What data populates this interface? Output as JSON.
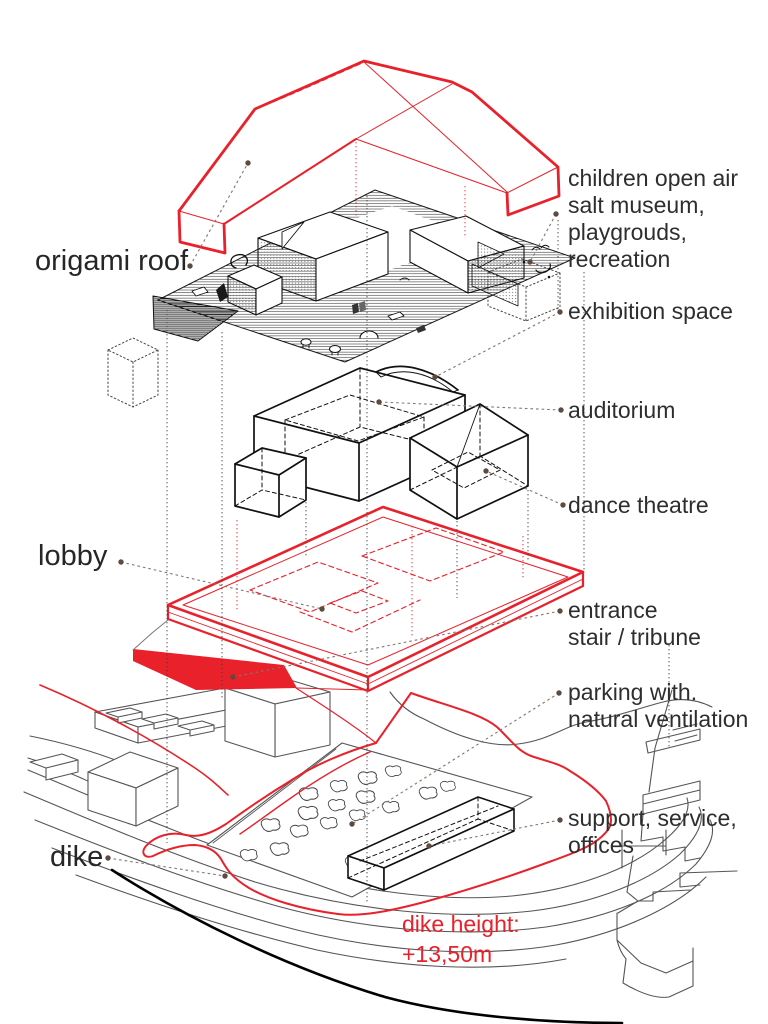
{
  "diagram": {
    "kind": "exploded axonometric architectural diagram",
    "colors": {
      "accent_red": "#e8212b",
      "ink": "#1a1a1a",
      "grey_line": "#555555",
      "leader": "#87756a",
      "leader_dot": "#5d4b40",
      "background": "#ffffff"
    },
    "labels": {
      "origami_roof": "origami roof",
      "lobby": "lobby",
      "dike": "dike",
      "children": [
        "children open air",
        "salt museum,",
        "playgrouds,",
        "recreation"
      ],
      "exhibition": "exhibition space",
      "auditorium": "auditorium",
      "dance_theatre": "dance theatre",
      "entrance": [
        "entrance",
        "stair / tribune"
      ],
      "parking": [
        "parking with.",
        "natural ventilation"
      ],
      "support": [
        "support, service,",
        "offices"
      ],
      "dike_height": [
        "dike height:",
        "+13,50m"
      ]
    }
  }
}
